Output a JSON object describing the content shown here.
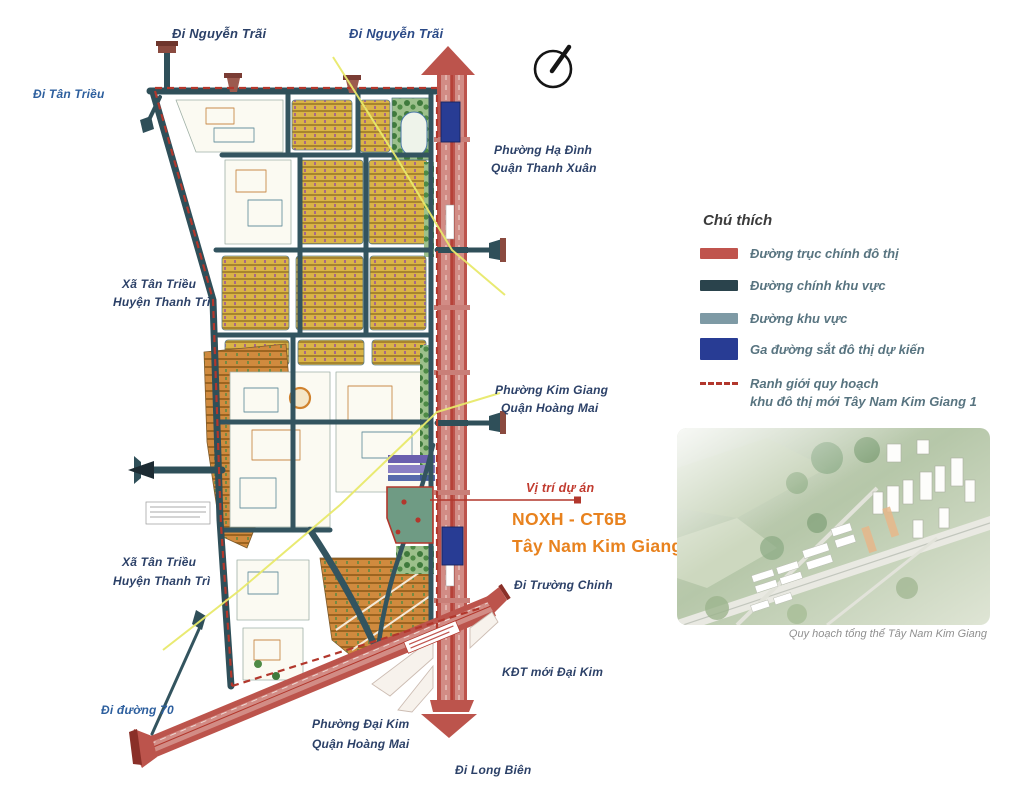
{
  "map_labels": {
    "di_nguyen_trai_left": "Đi Nguyễn Trãi",
    "di_nguyen_trai_right": "Đi Nguyễn Trãi",
    "di_tan_trieu": "Đi Tân Triều",
    "phuong_ha_dinh": "Phường Hạ Đình",
    "quan_thanh_xuan": "Quận Thanh Xuân",
    "xa_tan_trieu_1": "Xã Tân Triều",
    "huyen_thanh_tri_1": "Huyện Thanh Trì",
    "phuong_kim_giang": "Phường Kim Giang",
    "quan_hoang_mai_1": "Quận Hoàng Mai",
    "xa_tan_trieu_2": "Xã Tân Triều",
    "huyen_thanh_tri_2": "Huyện Thanh Trì",
    "di_truong_chinh": "Đi Trường Chinh",
    "kdt_moi_dai_kim": "KĐT mới Đại Kim",
    "di_duong_70": "Đi đường 70",
    "phuong_dai_kim": "Phường Đại Kim",
    "quan_hoang_mai_2": "Quận Hoàng Mai",
    "di_long_bien": "Đi Long Biên"
  },
  "project_callout": {
    "label": "Vị trí dự án",
    "name_line1": "NOXH - CT6B",
    "name_line2": "Tây Nam Kim Giang"
  },
  "legend": {
    "title": "Chú thích",
    "items": [
      {
        "label": "Đường trục chính đô thị",
        "color": "#c0544d"
      },
      {
        "label": "Đường chính khu vực",
        "color": "#2a434c"
      },
      {
        "label": "Đường khu vực",
        "color": "#7e9aa5"
      },
      {
        "label": "Ga đường sắt đô thị dự kiến",
        "color": "#283c94"
      },
      {
        "label": "Ranh giới quy hoạch",
        "label2": "khu đô thị mới Tây Nam Kim Giang 1",
        "color": "#b2372c"
      }
    ]
  },
  "aerial": {
    "caption": "Quy hoạch tổng thể Tây Nam Kim Giang"
  },
  "colors": {
    "main_road_red": "#bc544c",
    "regional_road_teal": "#2f4f59",
    "area_road_gray_blue": "#7e9aa5",
    "station_blue": "#283c94",
    "boundary_red": "#b2372c",
    "project_orange": "#e8821e",
    "callout_red": "#c13a2e",
    "label_navy": "#2c4168",
    "label_blue": "#2d5f9e",
    "legend_text": "#587480",
    "power_line_yellow": "#e8e96a"
  }
}
